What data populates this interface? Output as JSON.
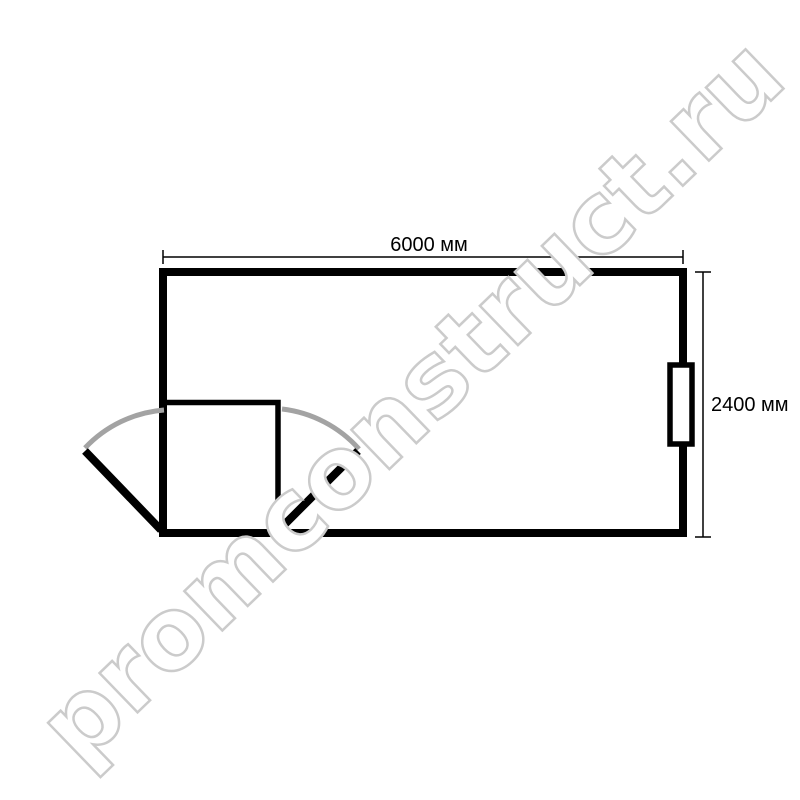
{
  "plan": {
    "type": "floor-plan",
    "dimensions": {
      "width": "6000 мм",
      "height": "2400 мм"
    },
    "features": {
      "window": "window-on-right-wall",
      "vestibule": "interior-partition-room",
      "door": "double-leaf-door-with-swing-arcs"
    }
  },
  "watermark": {
    "text": "promconstruct.ru"
  },
  "colors": {
    "background": "#ffffff",
    "wall": "#000000",
    "partition": "#000000",
    "door_leaf": "#000000",
    "door_arc": "#a3a3a3",
    "dimension_line": "#000000",
    "dimension_text": "#000000",
    "window_fill": "#ffffff",
    "window_stroke": "#000000",
    "watermark_fill": "#ffffff",
    "watermark_outline": "#cbcbcb"
  }
}
